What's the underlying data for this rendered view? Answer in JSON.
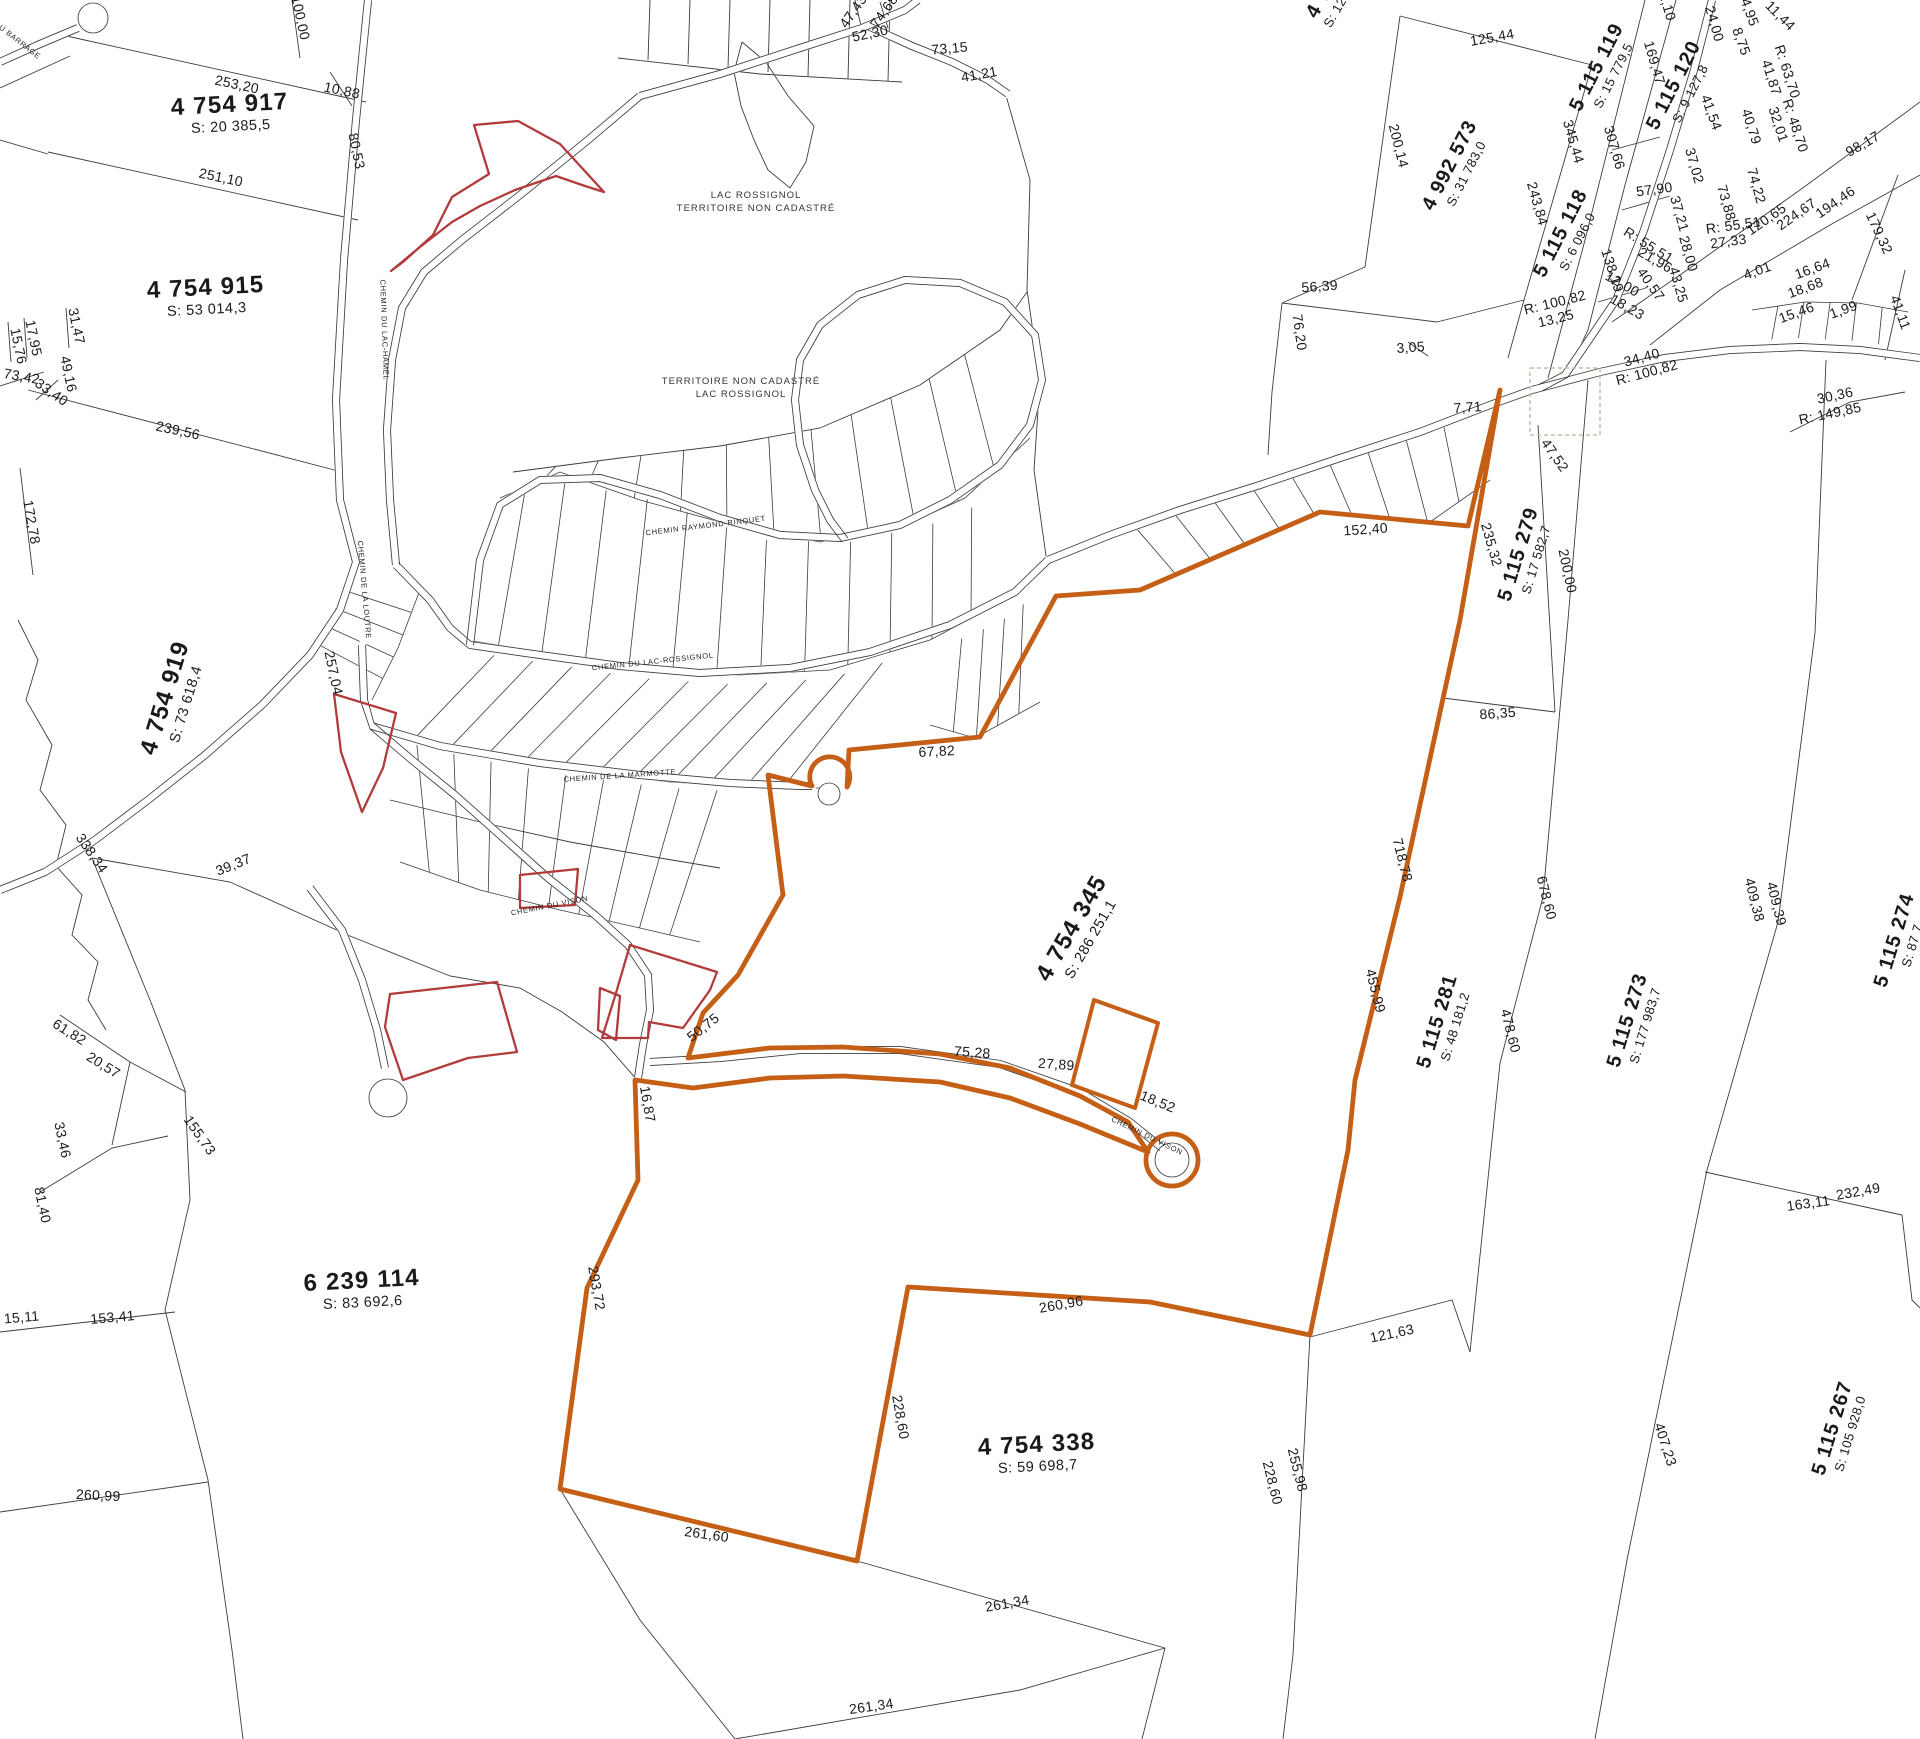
{
  "map_type": "cadastral-plan",
  "colors": {
    "highlight": "#c65f16",
    "red_parcel": "#b23b3b",
    "parcel_line": "#3c3c3c",
    "dashed_zone": "#aecba0",
    "text": "#1a1a1a"
  },
  "lots": [
    {
      "id": "4 754 917",
      "area": "S: 20 385,5",
      "x": 230,
      "y": 112,
      "rot": -3,
      "cls": "lg"
    },
    {
      "id": "4 754 915",
      "area": "S: 53 014,3",
      "x": 206,
      "y": 295,
      "rot": -3,
      "cls": "lg"
    },
    {
      "id": "4 754 919",
      "area": "S: 73 618,4",
      "x": 172,
      "y": 700,
      "rot": -73,
      "cls": "lg"
    },
    {
      "id": "6 239 114",
      "area": "S: 83 692,6",
      "x": 362,
      "y": 1288,
      "rot": -3,
      "cls": "lg"
    },
    {
      "id": "4 754 345",
      "area": "S: 286 251,1",
      "x": 1078,
      "y": 932,
      "rot": -60,
      "cls": "lg"
    },
    {
      "id": "4 754 338",
      "area": "S: 59 698,7",
      "x": 1037,
      "y": 1452,
      "rot": -3,
      "cls": "lg"
    },
    {
      "id": "4 992 573",
      "area": "S: 31 783,0",
      "x": 1455,
      "y": 168,
      "rot": -63,
      "cls": "md"
    },
    {
      "id": "5 115 118",
      "area": "S: 6 096,0",
      "x": 1566,
      "y": 236,
      "rot": -63,
      "cls": "md"
    },
    {
      "id": "5 115 119",
      "area": "S: 15 779,5",
      "x": 1602,
      "y": 70,
      "rot": -63,
      "cls": "md"
    },
    {
      "id": "5 115 120",
      "area": "S: 9 127,8",
      "x": 1679,
      "y": 88,
      "rot": -63,
      "cls": "md"
    },
    {
      "id": "5 115 279",
      "area": "S: 17 582,7",
      "x": 1524,
      "y": 556,
      "rot": -73,
      "cls": "md"
    },
    {
      "id": "5 115 281",
      "area": "S: 48 181,2",
      "x": 1443,
      "y": 1023,
      "rot": -73,
      "cls": "md"
    },
    {
      "id": "5 115 273",
      "area": "S: 177 983,7",
      "x": 1633,
      "y": 1022,
      "rot": -73,
      "cls": "md"
    },
    {
      "id": "5 115 274",
      "area": "S: 87 7",
      "x": 1900,
      "y": 942,
      "rot": -73,
      "cls": "md"
    },
    {
      "id": "5 115 267",
      "area": "S: 105 928,0",
      "x": 1838,
      "y": 1430,
      "rot": -73,
      "cls": "md"
    },
    {
      "id": "4 7",
      "area": "S: 12",
      "x": 1324,
      "y": 6,
      "rot": -60,
      "cls": "md"
    }
  ],
  "measurements": [
    {
      "v": "253,20",
      "x": 236,
      "y": 89,
      "r": 12
    },
    {
      "v": "10,88",
      "x": 341,
      "y": 95,
      "r": 12
    },
    {
      "v": "100,00",
      "x": 296,
      "y": 19,
      "r": 78
    },
    {
      "v": "251,10",
      "x": 220,
      "y": 182,
      "r": 12
    },
    {
      "v": "80,53",
      "x": 352,
      "y": 152,
      "r": 78
    },
    {
      "v": "239,56",
      "x": 177,
      "y": 435,
      "r": 12
    },
    {
      "v": "172,78",
      "x": 27,
      "y": 523,
      "r": 80
    },
    {
      "v": "15,76",
      "x": 14,
      "y": 347,
      "r": 78
    },
    {
      "v": "17,95",
      "x": 29,
      "y": 339,
      "r": 78
    },
    {
      "v": "31,47",
      "x": 72,
      "y": 327,
      "r": 78
    },
    {
      "v": "73,42",
      "x": 21,
      "y": 381,
      "r": 10
    },
    {
      "v": "33,40",
      "x": 49,
      "y": 396,
      "r": 35
    },
    {
      "v": "49,16",
      "x": 64,
      "y": 375,
      "r": 78
    },
    {
      "v": "47,43",
      "x": 857,
      "y": 14,
      "r": -55
    },
    {
      "v": "74,68",
      "x": 888,
      "y": 14,
      "r": -55
    },
    {
      "v": "52,30",
      "x": 871,
      "y": 38,
      "r": -12
    },
    {
      "v": "73,15",
      "x": 950,
      "y": 53,
      "r": -5
    },
    {
      "v": "41,21",
      "x": 980,
      "y": 79,
      "r": -10
    },
    {
      "v": "125,44",
      "x": 1493,
      "y": 42,
      "r": -10
    },
    {
      "v": "200,14",
      "x": 1394,
      "y": 147,
      "r": 76
    },
    {
      "v": "56,39",
      "x": 1320,
      "y": 291,
      "r": -4
    },
    {
      "v": "76,20",
      "x": 1295,
      "y": 333,
      "r": 82
    },
    {
      "v": "3,05",
      "x": 1411,
      "y": 352,
      "r": -4
    },
    {
      "v": "243,84",
      "x": 1533,
      "y": 205,
      "r": 74
    },
    {
      "v": "345,44",
      "x": 1569,
      "y": 143,
      "r": 74
    },
    {
      "v": "307,66",
      "x": 1610,
      "y": 149,
      "r": 74
    },
    {
      "v": "169,47",
      "x": 1650,
      "y": 64,
      "r": 74
    },
    {
      "v": "2,10",
      "x": 1663,
      "y": 8,
      "r": 74
    },
    {
      "v": "24,00",
      "x": 1710,
      "y": 25,
      "r": 74
    },
    {
      "v": "8,75",
      "x": 1737,
      "y": 43,
      "r": 70
    },
    {
      "v": "24,95",
      "x": 1744,
      "y": 10,
      "r": 70
    },
    {
      "v": "11,44",
      "x": 1777,
      "y": 19,
      "r": 45
    },
    {
      "v": "41,54",
      "x": 1707,
      "y": 114,
      "r": 70
    },
    {
      "v": "41,87",
      "x": 1767,
      "y": 79,
      "r": 72
    },
    {
      "v": "R: 63,70",
      "x": 1783,
      "y": 73,
      "r": 72
    },
    {
      "v": "32,01",
      "x": 1774,
      "y": 126,
      "r": 72
    },
    {
      "v": "R: 48,70",
      "x": 1791,
      "y": 127,
      "r": 72
    },
    {
      "v": "40,79",
      "x": 1747,
      "y": 128,
      "r": 72
    },
    {
      "v": "37,02",
      "x": 1690,
      "y": 167,
      "r": 74
    },
    {
      "v": "57,90",
      "x": 1655,
      "y": 194,
      "r": -8
    },
    {
      "v": "37,21",
      "x": 1675,
      "y": 215,
      "r": 74
    },
    {
      "v": "73,88",
      "x": 1722,
      "y": 204,
      "r": 74
    },
    {
      "v": "74,22",
      "x": 1752,
      "y": 187,
      "r": 74
    },
    {
      "v": "98,17",
      "x": 1865,
      "y": 148,
      "r": -30
    },
    {
      "v": "194,46",
      "x": 1838,
      "y": 206,
      "r": -35
    },
    {
      "v": "224,67",
      "x": 1799,
      "y": 218,
      "r": -35
    },
    {
      "v": "120,65",
      "x": 1769,
      "y": 223,
      "r": -35
    },
    {
      "v": "R: 55,51",
      "x": 1734,
      "y": 230,
      "r": -8
    },
    {
      "v": "27,33",
      "x": 1729,
      "y": 246,
      "r": -8
    },
    {
      "v": "179,32",
      "x": 1875,
      "y": 235,
      "r": 65
    },
    {
      "v": "138,19",
      "x": 1608,
      "y": 272,
      "r": 72
    },
    {
      "v": "R: 55,51",
      "x": 1646,
      "y": 249,
      "r": 32
    },
    {
      "v": "21,96",
      "x": 1653,
      "y": 264,
      "r": 30
    },
    {
      "v": "12,00",
      "x": 1620,
      "y": 288,
      "r": 30
    },
    {
      "v": "40,57",
      "x": 1647,
      "y": 287,
      "r": 55
    },
    {
      "v": "43,25",
      "x": 1674,
      "y": 286,
      "r": 74
    },
    {
      "v": "28,00",
      "x": 1684,
      "y": 255,
      "r": 74
    },
    {
      "v": "18,23",
      "x": 1625,
      "y": 311,
      "r": 30
    },
    {
      "v": "4,01",
      "x": 1759,
      "y": 275,
      "r": -20
    },
    {
      "v": "16,64",
      "x": 1814,
      "y": 273,
      "r": -20
    },
    {
      "v": "18,68",
      "x": 1807,
      "y": 292,
      "r": -20
    },
    {
      "v": "15,46",
      "x": 1798,
      "y": 317,
      "r": -20
    },
    {
      "v": "1,99",
      "x": 1845,
      "y": 314,
      "r": -20
    },
    {
      "v": "41,11",
      "x": 1896,
      "y": 314,
      "r": 70
    },
    {
      "v": "34,40",
      "x": 1643,
      "y": 362,
      "r": -15
    },
    {
      "v": "R: 100,82",
      "x": 1648,
      "y": 377,
      "r": -15
    },
    {
      "v": "R: 100,82",
      "x": 1556,
      "y": 307,
      "r": -14
    },
    {
      "v": "13,25",
      "x": 1557,
      "y": 323,
      "r": -14
    },
    {
      "v": "30,36",
      "x": 1836,
      "y": 400,
      "r": -12
    },
    {
      "v": "R: 149,85",
      "x": 1831,
      "y": 418,
      "r": -12
    },
    {
      "v": "47,52",
      "x": 1551,
      "y": 458,
      "r": 55
    },
    {
      "v": "7,71",
      "x": 1468,
      "y": 412,
      "r": -4
    },
    {
      "v": "235,32",
      "x": 1487,
      "y": 546,
      "r": 74
    },
    {
      "v": "200,00",
      "x": 1563,
      "y": 572,
      "r": 78
    },
    {
      "v": "152,40",
      "x": 1366,
      "y": 534,
      "r": -4
    },
    {
      "v": "86,35",
      "x": 1498,
      "y": 718,
      "r": -4
    },
    {
      "v": "718,78",
      "x": 1398,
      "y": 861,
      "r": 76
    },
    {
      "v": "678,60",
      "x": 1542,
      "y": 899,
      "r": 76
    },
    {
      "v": "455,99",
      "x": 1371,
      "y": 992,
      "r": 76
    },
    {
      "v": "478,60",
      "x": 1506,
      "y": 1032,
      "r": 76
    },
    {
      "v": "409,38",
      "x": 1750,
      "y": 901,
      "r": 76
    },
    {
      "v": "409,39",
      "x": 1772,
      "y": 905,
      "r": 76
    },
    {
      "v": "67,82",
      "x": 937,
      "y": 756,
      "r": -3
    },
    {
      "v": "50,75",
      "x": 706,
      "y": 1031,
      "r": -38
    },
    {
      "v": "16,87",
      "x": 643,
      "y": 1105,
      "r": 80
    },
    {
      "v": "75,28",
      "x": 972,
      "y": 1057,
      "r": 4
    },
    {
      "v": "27,89",
      "x": 1056,
      "y": 1069,
      "r": 4
    },
    {
      "v": "18,52",
      "x": 1156,
      "y": 1106,
      "r": 22
    },
    {
      "v": "293,72",
      "x": 592,
      "y": 1289,
      "r": 80
    },
    {
      "v": "260,96",
      "x": 1062,
      "y": 1309,
      "r": -10
    },
    {
      "v": "121,63",
      "x": 1393,
      "y": 1338,
      "r": -12
    },
    {
      "v": "228,60",
      "x": 896,
      "y": 1418,
      "r": 80
    },
    {
      "v": "261,60",
      "x": 706,
      "y": 1539,
      "r": 8
    },
    {
      "v": "261,34",
      "x": 1008,
      "y": 1608,
      "r": -10
    },
    {
      "v": "261,34",
      "x": 872,
      "y": 1711,
      "r": -8
    },
    {
      "v": "255,98",
      "x": 1293,
      "y": 1471,
      "r": 76
    },
    {
      "v": "228,60",
      "x": 1268,
      "y": 1484,
      "r": 76
    },
    {
      "v": "232,49",
      "x": 1859,
      "y": 1196,
      "r": -10
    },
    {
      "v": "163,11",
      "x": 1809,
      "y": 1208,
      "r": -8
    },
    {
      "v": "407,23",
      "x": 1661,
      "y": 1446,
      "r": 72
    },
    {
      "v": "155,73",
      "x": 196,
      "y": 1138,
      "r": 55
    },
    {
      "v": "153,41",
      "x": 113,
      "y": 1322,
      "r": -5
    },
    {
      "v": "15,11",
      "x": 22,
      "y": 1322,
      "r": -5
    },
    {
      "v": "81,40",
      "x": 38,
      "y": 1206,
      "r": 78
    },
    {
      "v": "33,46",
      "x": 58,
      "y": 1141,
      "r": 78
    },
    {
      "v": "20,57",
      "x": 101,
      "y": 1069,
      "r": 32
    },
    {
      "v": "61,82",
      "x": 67,
      "y": 1036,
      "r": 32
    },
    {
      "v": "338,34",
      "x": 88,
      "y": 856,
      "r": 55
    },
    {
      "v": "39,37",
      "x": 235,
      "y": 869,
      "r": -22
    },
    {
      "v": "257,04",
      "x": 329,
      "y": 674,
      "r": 78
    },
    {
      "v": "260,99",
      "x": 98,
      "y": 1500,
      "r": 3
    }
  ],
  "road_labels": [
    {
      "name": "DU BARRAGE",
      "x": 16,
      "y": 42,
      "r": 38
    },
    {
      "name": "CHEMIN DU LAC-HAMEL",
      "x": 382,
      "y": 330,
      "r": 88
    },
    {
      "name": "CHEMIN DE LA LOUTRE",
      "x": 362,
      "y": 590,
      "r": 85
    },
    {
      "name": "CHEMIN RAYMOND-RINQUET",
      "x": 706,
      "y": 528,
      "r": -7
    },
    {
      "name": "CHEMIN DU LAC-ROSSIGNOL",
      "x": 653,
      "y": 664,
      "r": -6
    },
    {
      "name": "CHEMIN DE LA MARMOTTE",
      "x": 620,
      "y": 778,
      "r": -4
    },
    {
      "name": "CHEMIN DU VISON",
      "x": 550,
      "y": 908,
      "r": -11
    },
    {
      "name": "CHEMIN DU VISON",
      "x": 1146,
      "y": 1138,
      "r": 26
    }
  ],
  "notes": [
    {
      "l1": "LAC ROSSIGNOL",
      "l2": "TERRITOIRE NON CADASTRÉ",
      "x": 756,
      "y": 198
    },
    {
      "l1": "TERRITOIRE NON CADASTRÉ",
      "l2": "LAC ROSSIGNOL",
      "x": 741,
      "y": 384
    }
  ]
}
